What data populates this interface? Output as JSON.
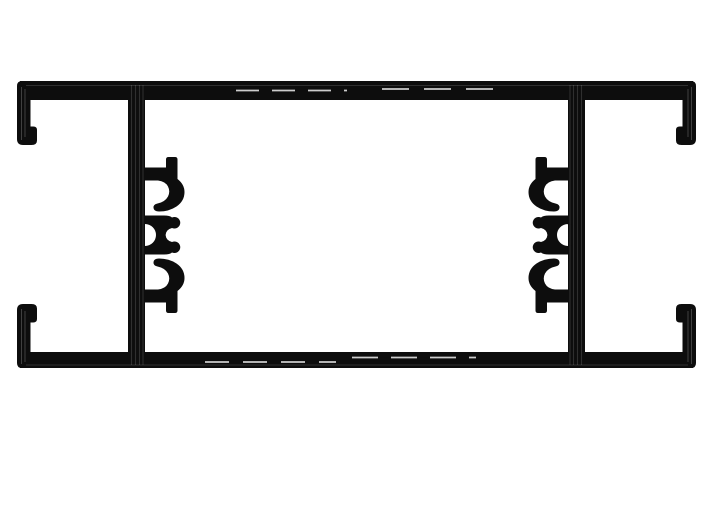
{
  "page": {
    "background": "#ffffff"
  },
  "canvas": {
    "width": 713,
    "height": 525
  },
  "colors": {
    "ink": "#0d0d0d",
    "highlight_dash": "#cccccc",
    "metal_streak_cap": "rgba(255,255,255,0.24)",
    "metal_streak_web": "rgba(255,255,255,0.14)"
  },
  "drawing": {
    "description": "Cross-section of a symmetric aluminum extrusion profile: top and bottom flanges ending in hooked glazing channels, two vertical webs, each web carrying a stack of screw-boss hooks facing the profile center",
    "shapes": [
      {
        "name": "top-rail",
        "type": "rect",
        "x": 20,
        "y": 81,
        "w": 673,
        "h": 19,
        "fill": "ink"
      },
      {
        "name": "bottom-rail",
        "type": "rect",
        "x": 20,
        "y": 352,
        "w": 673,
        "h": 16,
        "fill": "ink"
      },
      {
        "name": "left-web",
        "type": "rect",
        "x": 128,
        "y": 83,
        "w": 17,
        "h": 283,
        "fill": "ink"
      },
      {
        "name": "right-web",
        "type": "rect",
        "x": 568,
        "y": 83,
        "w": 17,
        "h": 283,
        "fill": "ink"
      },
      {
        "name": "end-channel-top-left",
        "type": "path",
        "fill": "ink",
        "d": "M22,81 Q17,81 17,86 L17,139 Q17,145 23,145 L31.5,145 Q37,145 37,140.5 L37,130 Q37,126.5 33.2,126.5 L30.5,126.5 L30.5,81 Z"
      },
      {
        "name": "end-channel-top-right",
        "type": "path",
        "fill": "ink",
        "transform": "translate(713,0) scale(-1,1)",
        "d": "M22,81 Q17,81 17,86 L17,139 Q17,145 23,145 L31.5,145 Q37,145 37,140.5 L37,130 Q37,126.5 33.2,126.5 L30.5,126.5 L30.5,81 Z"
      },
      {
        "name": "end-channel-bottom-left",
        "type": "path",
        "fill": "ink",
        "d": "M22,368 Q17,368 17,363 L17,310 Q17,304 23,304 L31.5,304 Q37,304 37,308.5 L37,319 Q37,322.5 33.2,322.5 L30.5,322.5 L30.5,368 Z"
      },
      {
        "name": "end-channel-bottom-right",
        "type": "path",
        "fill": "ink",
        "transform": "translate(713,0) scale(-1,1)",
        "d": "M22,368 Q17,368 17,363 L17,310 Q17,304 23,304 L31.5,304 Q37,304 37,308.5 L37,319 Q37,322.5 33.2,322.5 L30.5,322.5 L30.5,368 Z"
      },
      {
        "name": "screw-boss-upper-left",
        "type": "path",
        "fill": "ink",
        "d": "M145,167.5 L166,167.5 L166,159.5 Q166,157 168.5,157 L175,157 Q177.5,157 177.5,159.5 L177.5,179 Q184.5,184.5 184.5,192 Q184.5,201 176.5,206.5 Q169,211.5 159,211.5 Q154,211.5 153.5,208 Q153,204.5 157.5,203.5 Q165,202 168,196.5 Q170.5,191.5 168,186.5 Q165.5,181.5 158,180.5 L145,180.5 Z"
      },
      {
        "name": "screw-boss-middle-left",
        "type": "path",
        "fill": "ink",
        "fill_rule": "evenodd",
        "d": "M145,215.5 L164,215.5 Q170,215.5 172,217.5 A5.8,5.8 0 1 1 172,228 Q166,229.5 165.6,235 Q166,240.5 172,242 A5.8,5.8 0 1 1 172,252.5 Q170,254.5 164,254.5 L145,254.5 Z M134,235 A11,11 0 1 0 156,235 A11,11 0 1 0 134,235 Z"
      },
      {
        "name": "screw-boss-lower-left",
        "type": "path",
        "fill": "ink",
        "d": "M145,302.5 L166,302.5 L166,310.5 Q166,313 168.5,313 L175,313 Q177.5,313 177.5,310.5 L177.5,291 Q184.5,285.5 184.5,278 Q184.5,269 176.5,263.5 Q169,258.5 159,258.5 Q154,258.5 153.5,262 Q153,265.5 157.5,266.5 Q165,268 168,273.5 Q170.5,278.5 168,283.5 Q165.5,288.5 158,289.5 L145,289.5 Z"
      },
      {
        "name": "screw-boss-upper-right",
        "type": "path",
        "fill": "ink",
        "transform": "translate(713,0) scale(-1,1)",
        "d": "M145,167.5 L166,167.5 L166,159.5 Q166,157 168.5,157 L175,157 Q177.5,157 177.5,159.5 L177.5,179 Q184.5,184.5 184.5,192 Q184.5,201 176.5,206.5 Q169,211.5 159,211.5 Q154,211.5 153.5,208 Q153,204.5 157.5,203.5 Q165,202 168,196.5 Q170.5,191.5 168,186.5 Q165.5,181.5 158,180.5 L145,180.5 Z"
      },
      {
        "name": "screw-boss-middle-right",
        "type": "path",
        "fill": "ink",
        "fill_rule": "evenodd",
        "transform": "translate(713,0) scale(-1,1)",
        "d": "M145,215.5 L164,215.5 Q170,215.5 172,217.5 A5.8,5.8 0 1 1 172,228 Q166,229.5 165.6,235 Q166,240.5 172,242 A5.8,5.8 0 1 1 172,252.5 Q170,254.5 164,254.5 L145,254.5 Z M134,235 A11,11 0 1 0 156,235 A11,11 0 1 0 134,235 Z"
      },
      {
        "name": "screw-boss-lower-right",
        "type": "path",
        "fill": "ink",
        "transform": "translate(713,0) scale(-1,1)",
        "d": "M145,302.5 L166,302.5 L166,310.5 Q166,313 168.5,313 L175,313 Q177.5,313 177.5,310.5 L177.5,291 Q184.5,285.5 184.5,278 Q184.5,269 176.5,263.5 Q169,258.5 159,258.5 Q154,258.5 153.5,262 Q153,265.5 157.5,266.5 Q165,268 168,273.5 Q170.5,278.5 168,283.5 Q165.5,288.5 158,289.5 L145,289.5 Z"
      }
    ],
    "strokes": [
      {
        "name": "top-rail-highlight-dash-left",
        "x1": 236,
        "y1": 90.5,
        "x2": 347,
        "y2": 90.5,
        "stroke": "highlight_dash",
        "width": 1.8,
        "dasharray": "23 13"
      },
      {
        "name": "top-rail-highlight-dash-right",
        "x1": 382,
        "y1": 89,
        "x2": 506,
        "y2": 89,
        "stroke": "highlight_dash",
        "width": 1.8,
        "dasharray": "27 15"
      },
      {
        "name": "bottom-rail-highlight-dash-left",
        "x1": 205,
        "y1": 362,
        "x2": 336,
        "y2": 362,
        "stroke": "highlight_dash",
        "width": 1.8,
        "dasharray": "24 14"
      },
      {
        "name": "bottom-rail-highlight-dash-right",
        "x1": 352,
        "y1": 357.5,
        "x2": 476,
        "y2": 357.5,
        "stroke": "highlight_dash",
        "width": 1.8,
        "dasharray": "26 13"
      },
      {
        "name": "cap-streak-top-left-1",
        "x1": 21.5,
        "y1": 87,
        "x2": 21.5,
        "y2": 140,
        "stroke": "metal_streak_cap",
        "width": 0.9
      },
      {
        "name": "cap-streak-top-left-2",
        "x1": 25,
        "y1": 89,
        "x2": 25,
        "y2": 137,
        "stroke": "metal_streak_cap",
        "width": 0.9
      },
      {
        "name": "cap-streak-top-right-1",
        "x1": 691.5,
        "y1": 87,
        "x2": 691.5,
        "y2": 140,
        "stroke": "metal_streak_cap",
        "width": 0.9
      },
      {
        "name": "cap-streak-top-right-2",
        "x1": 688,
        "y1": 89,
        "x2": 688,
        "y2": 137,
        "stroke": "metal_streak_cap",
        "width": 0.9
      },
      {
        "name": "cap-streak-bottom-left-1",
        "x1": 21.5,
        "y1": 309,
        "x2": 21.5,
        "y2": 364,
        "stroke": "metal_streak_cap",
        "width": 0.9
      },
      {
        "name": "cap-streak-bottom-left-2",
        "x1": 25,
        "y1": 311,
        "x2": 25,
        "y2": 362,
        "stroke": "metal_streak_cap",
        "width": 0.9
      },
      {
        "name": "cap-streak-bottom-right-1",
        "x1": 691.5,
        "y1": 309,
        "x2": 691.5,
        "y2": 364,
        "stroke": "metal_streak_cap",
        "width": 0.9
      },
      {
        "name": "cap-streak-bottom-right-2",
        "x1": 688,
        "y1": 311,
        "x2": 688,
        "y2": 362,
        "stroke": "metal_streak_cap",
        "width": 0.9
      },
      {
        "name": "web-streak-left-1",
        "x1": 131.5,
        "y1": 85,
        "x2": 131.5,
        "y2": 365,
        "stroke": "metal_streak_web",
        "width": 1.1
      },
      {
        "name": "web-streak-left-2",
        "x1": 135.5,
        "y1": 85,
        "x2": 135.5,
        "y2": 365,
        "stroke": "metal_streak_web",
        "width": 1.1
      },
      {
        "name": "web-streak-left-3",
        "x1": 139.5,
        "y1": 85,
        "x2": 139.5,
        "y2": 365,
        "stroke": "metal_streak_web",
        "width": 1.1
      },
      {
        "name": "web-streak-left-4",
        "x1": 143,
        "y1": 85,
        "x2": 143,
        "y2": 365,
        "stroke": "metal_streak_web",
        "width": 1.1
      },
      {
        "name": "web-streak-right-1",
        "x1": 581.5,
        "y1": 85,
        "x2": 581.5,
        "y2": 365,
        "stroke": "metal_streak_web",
        "width": 1.1
      },
      {
        "name": "web-streak-right-2",
        "x1": 577.5,
        "y1": 85,
        "x2": 577.5,
        "y2": 365,
        "stroke": "metal_streak_web",
        "width": 1.1
      },
      {
        "name": "web-streak-right-3",
        "x1": 573.5,
        "y1": 85,
        "x2": 573.5,
        "y2": 365,
        "stroke": "metal_streak_web",
        "width": 1.1
      },
      {
        "name": "web-streak-right-4",
        "x1": 570,
        "y1": 85,
        "x2": 570,
        "y2": 365,
        "stroke": "metal_streak_web",
        "width": 1.1
      },
      {
        "name": "top-rail-sheen",
        "x1": 26,
        "y1": 85.5,
        "x2": 688,
        "y2": 85.5,
        "stroke": "metal_streak_web",
        "width": 1
      },
      {
        "name": "bottom-rail-sheen",
        "x1": 26,
        "y1": 365,
        "x2": 688,
        "y2": 365,
        "stroke": "metal_streak_web",
        "width": 1
      }
    ]
  }
}
